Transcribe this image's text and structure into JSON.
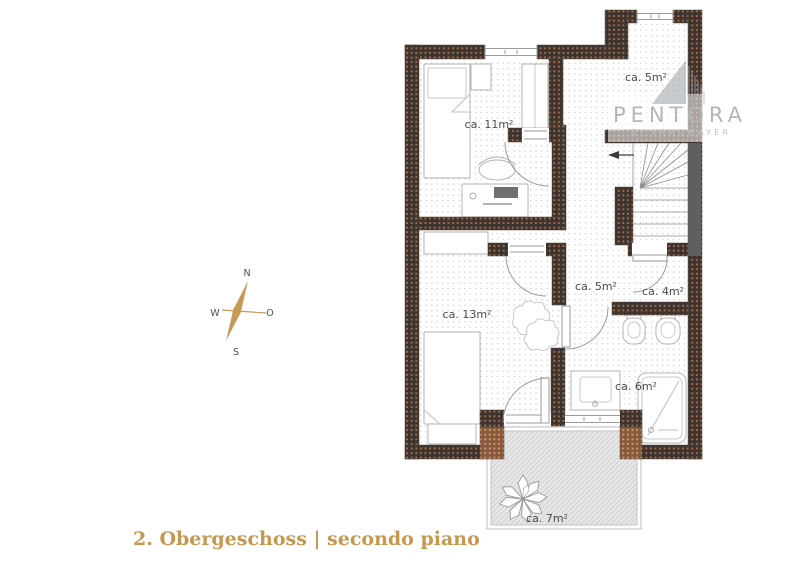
{
  "title": {
    "floor_label": "2. Obergeschoss | secondo piano"
  },
  "compass": {
    "north": "N",
    "east": "O",
    "south": "S",
    "west": "W"
  },
  "watermark": {
    "brand": "PENTORA",
    "tagline": "BY IMMOMAYER"
  },
  "rooms": {
    "bedroom_top": {
      "area": "ca. 11m²"
    },
    "landing_top": {
      "area": "ca. 5m²"
    },
    "hallway": {
      "area": "ca. 5m²"
    },
    "storage": {
      "area": "ca. 4m²"
    },
    "bedroom_bottom": {
      "area": "ca. 13m²"
    },
    "bathroom": {
      "area": "ca. 6m²"
    },
    "balcony": {
      "area": "ca. 7m²"
    }
  },
  "colors": {
    "accent_gold": "#c6974f",
    "wall_dark": "#3b3430",
    "wall_dot_orange": "#aa6c45",
    "wall_terracotta": "#875a3e",
    "balcony_gray": "#e7e7e7",
    "label_gray": "#4c4c4c",
    "watermark_gray": "#b2b6b9"
  }
}
